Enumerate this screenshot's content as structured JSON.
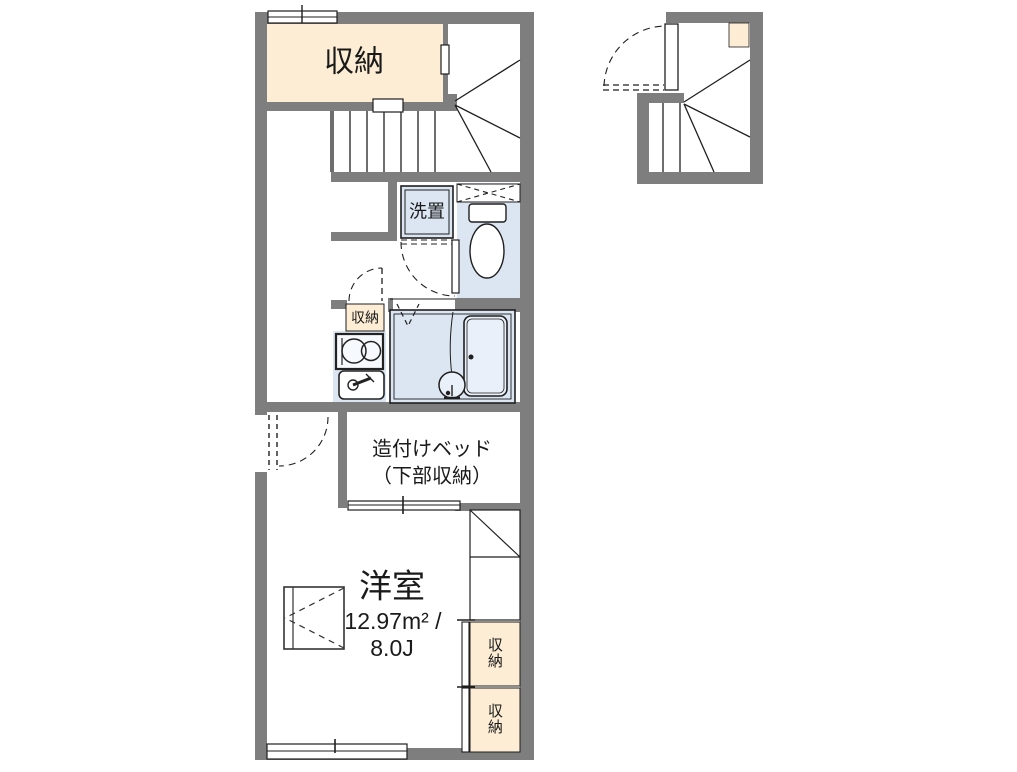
{
  "plan": {
    "type": "apartment-floor-plan",
    "rooms": {
      "closet_top": "収納",
      "washer_space": "洗置",
      "kitchen_closet": "収納",
      "built_in_bed_line1": "造付けベッド",
      "built_in_bed_line2": "（下部収納）",
      "main_room_name": "洋室",
      "main_room_area": "12.97m² /",
      "main_room_size": "8.0J",
      "right_closet_upper": "収納",
      "right_closet_lower": "収納"
    }
  },
  "colors": {
    "wall_gray": "#7e7e7e",
    "closet_beige": "#fcedd4",
    "wet_area_blue": "#dce6f3",
    "tub_fill": "#eaf0f9",
    "line_black": "#1f1f1f",
    "background": "#ffffff"
  }
}
